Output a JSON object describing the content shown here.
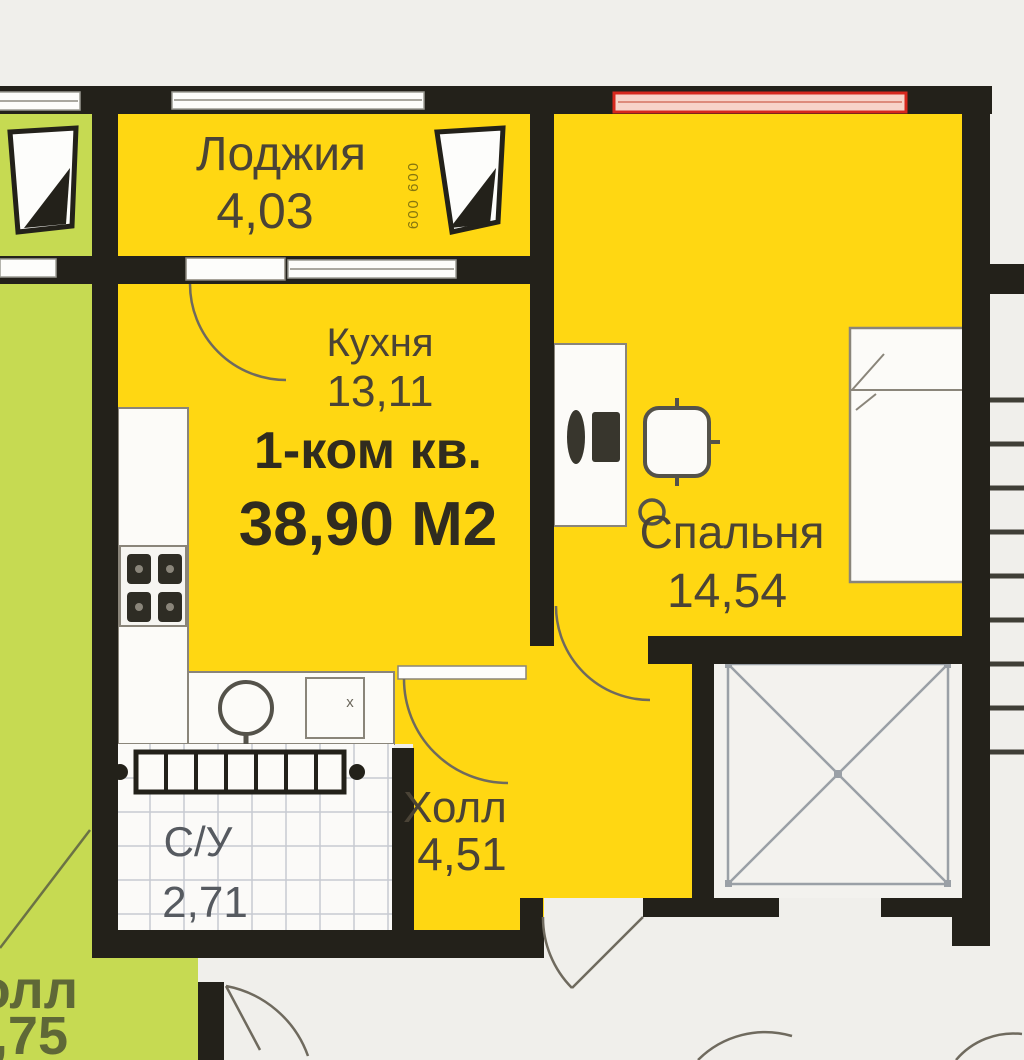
{
  "plan": {
    "apartment": {
      "title": "1-ком кв.",
      "area": "38,90 М2",
      "rooms": {
        "loggia": {
          "name": "Лоджия",
          "area": "4,03"
        },
        "kitchen": {
          "name": "Кухня",
          "area": "13,11"
        },
        "bedroom": {
          "name": "Спальня",
          "area": "14,54"
        },
        "hall": {
          "name": "Холл",
          "area": "4,51"
        },
        "bathroom": {
          "name": "С/У",
          "area": "2,71"
        }
      },
      "vent_shaft_label": "600 600",
      "appliance_mark": "x"
    },
    "neighbor_apartment": {
      "room_name_fragment": "олл",
      "room_area_fragment": ",75"
    },
    "colors": {
      "apartment_fill": "#ffd712",
      "neighbor_fill": "#c6da52",
      "wall": "#23211a",
      "window_highlight": "#d6281e",
      "background": "#f0efeb",
      "tile_line": "#c7cad1",
      "elevator_line": "#9aa0a6"
    }
  }
}
